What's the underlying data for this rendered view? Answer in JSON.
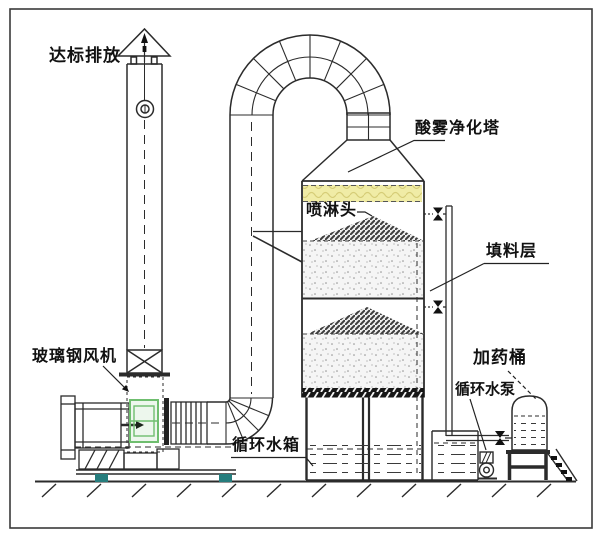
{
  "diagram": {
    "labels": {
      "emission": "达标排放",
      "tower": "酸雾净化塔",
      "spray_head": "喷淋头",
      "packing_layer": "填料层",
      "fan": "玻璃钢风机",
      "water_tank": "循环水箱",
      "water_pump": "循环水泵",
      "dosing_barrel": "加药桶"
    },
    "colors": {
      "line": "#2b2b2b",
      "demister_fill": "#f0eca6",
      "fan_highlight": "#6fbe6f",
      "foot": "#267d7d"
    }
  }
}
